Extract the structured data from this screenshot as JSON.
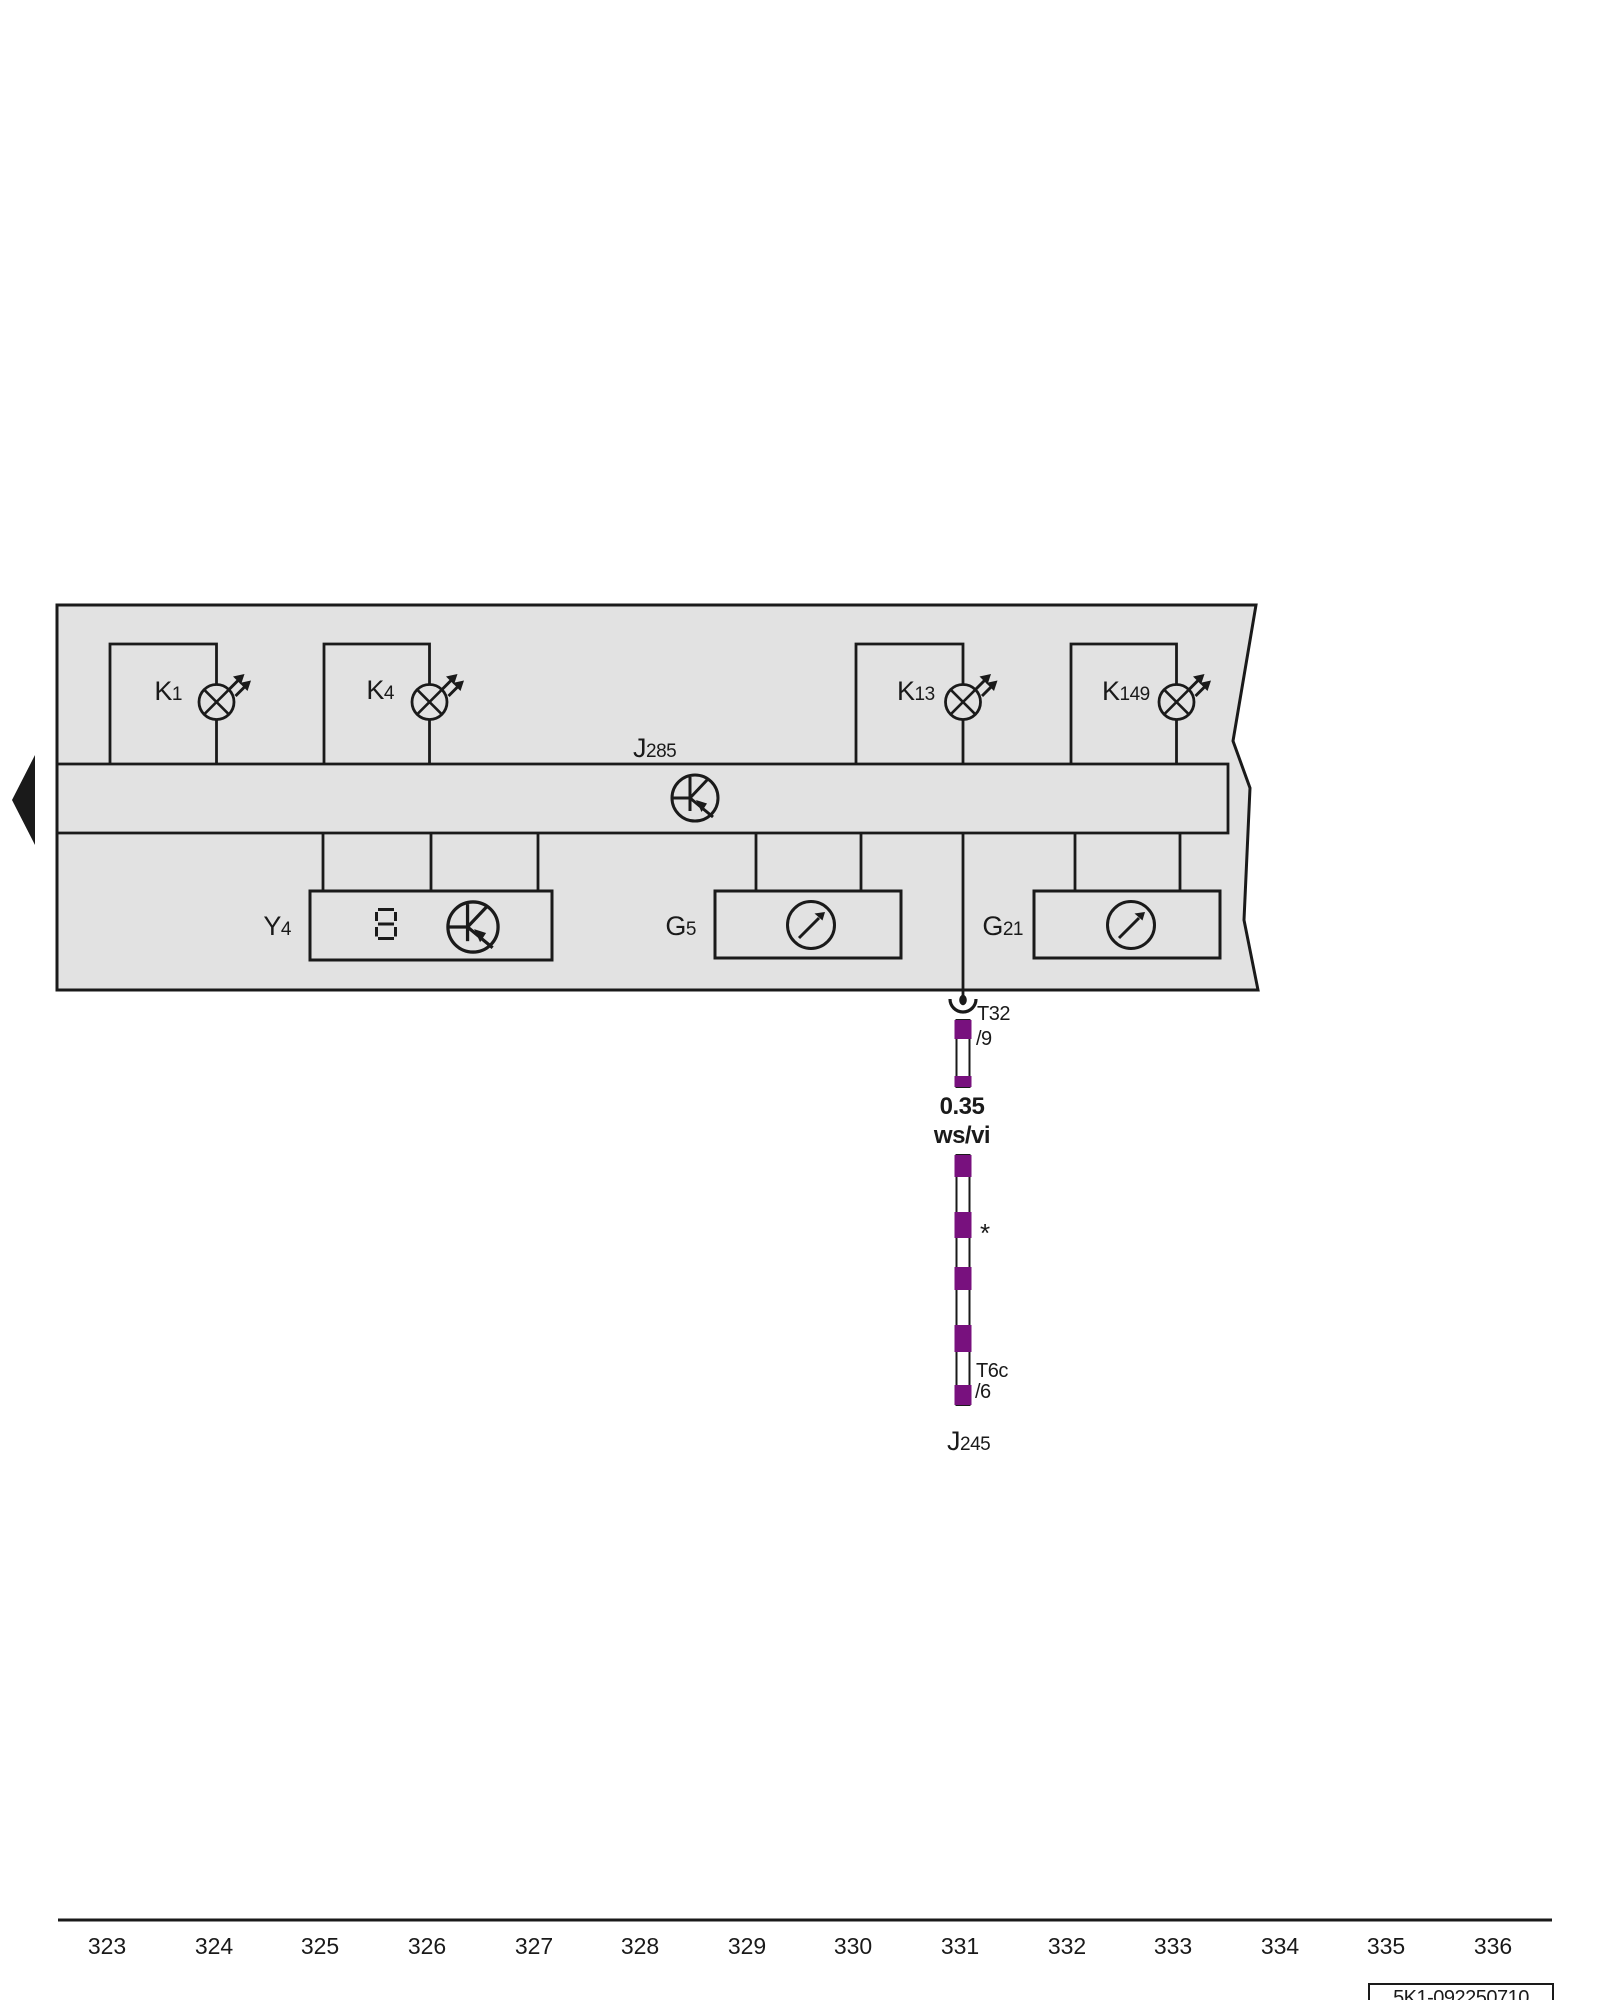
{
  "diagram": {
    "kind": "current-flow-wiring-diagram",
    "components": {
      "k1": {
        "prefix": "K",
        "sub": "1"
      },
      "k4": {
        "prefix": "K",
        "sub": "4"
      },
      "k13": {
        "prefix": "K",
        "sub": "13"
      },
      "k149": {
        "prefix": "K",
        "sub": "149"
      },
      "j285": {
        "prefix": "J",
        "sub": "285"
      },
      "y4": {
        "prefix": "Y",
        "sub": "4"
      },
      "g5": {
        "prefix": "G",
        "sub": "5"
      },
      "g21": {
        "prefix": "G",
        "sub": "21"
      },
      "j245": {
        "prefix": "J",
        "sub": "245"
      }
    },
    "connectors": {
      "top": {
        "name": "T32",
        "pin": "/9"
      },
      "bottom": {
        "name": "T6c",
        "pin": "/6"
      }
    },
    "wire": {
      "cross_section": "0.35",
      "color_code": "ws/vi",
      "footnote_mark": "*"
    },
    "ruler": {
      "numbers": [
        "323",
        "324",
        "325",
        "326",
        "327",
        "328",
        "329",
        "330",
        "331",
        "332",
        "333",
        "334",
        "335",
        "336"
      ]
    },
    "title_block": {
      "code": "5K1-092250710"
    },
    "colors": {
      "band": "#e2e2e2",
      "line": "#1a1a1a",
      "wire_purple": "#78117e",
      "background": "#ffffff"
    }
  }
}
